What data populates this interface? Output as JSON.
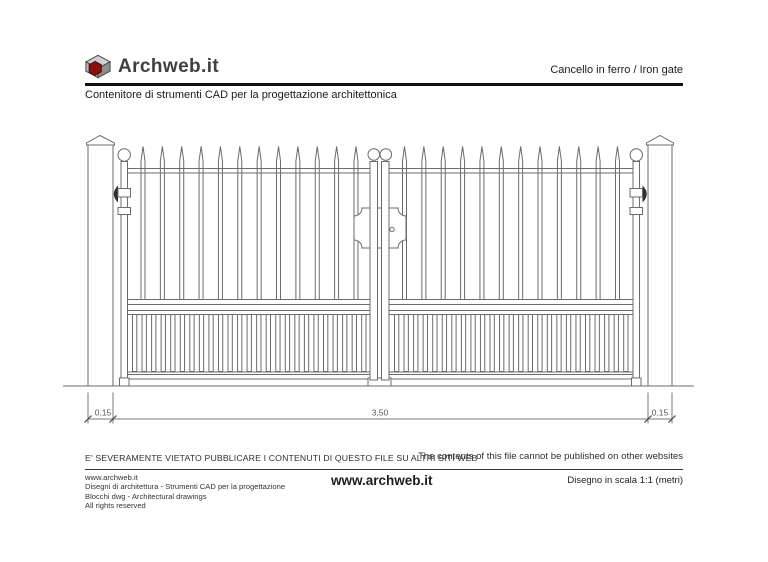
{
  "header": {
    "logo_text": "Archweb.it",
    "page_title": "Cancello in ferro  /  Iron gate",
    "tagline": "Contenitore di strumenti CAD per la progettazione architettonica"
  },
  "drawing": {
    "subject": "iron gate elevation",
    "dimensions": {
      "left": "0,15",
      "center": "3,50",
      "right": "0,15"
    }
  },
  "footer": {
    "warning_it": "E' SEVERAMENTE VIETATO PUBBLICARE I CONTENUTI DI QUESTO FILE SU ALTRI SITI WEB",
    "warning_en": "The contents of this file cannot be published on other websites",
    "info_lines": [
      "www.archweb.it",
      "Disegni di architettura - Strumenti CAD  per la progettazione",
      "Blocchi dwg - Architectural drawings",
      "All rights reserved"
    ],
    "site": "www.archweb.it",
    "scale_note": "Disegno in scala 1:1 (metri)"
  },
  "colors": {
    "line_gray": "#6b6b6b",
    "dim_gray": "#555555",
    "hinge_dark": "#2e2e2e",
    "logo_red": "#8b1111",
    "header_dark": "#111111"
  }
}
